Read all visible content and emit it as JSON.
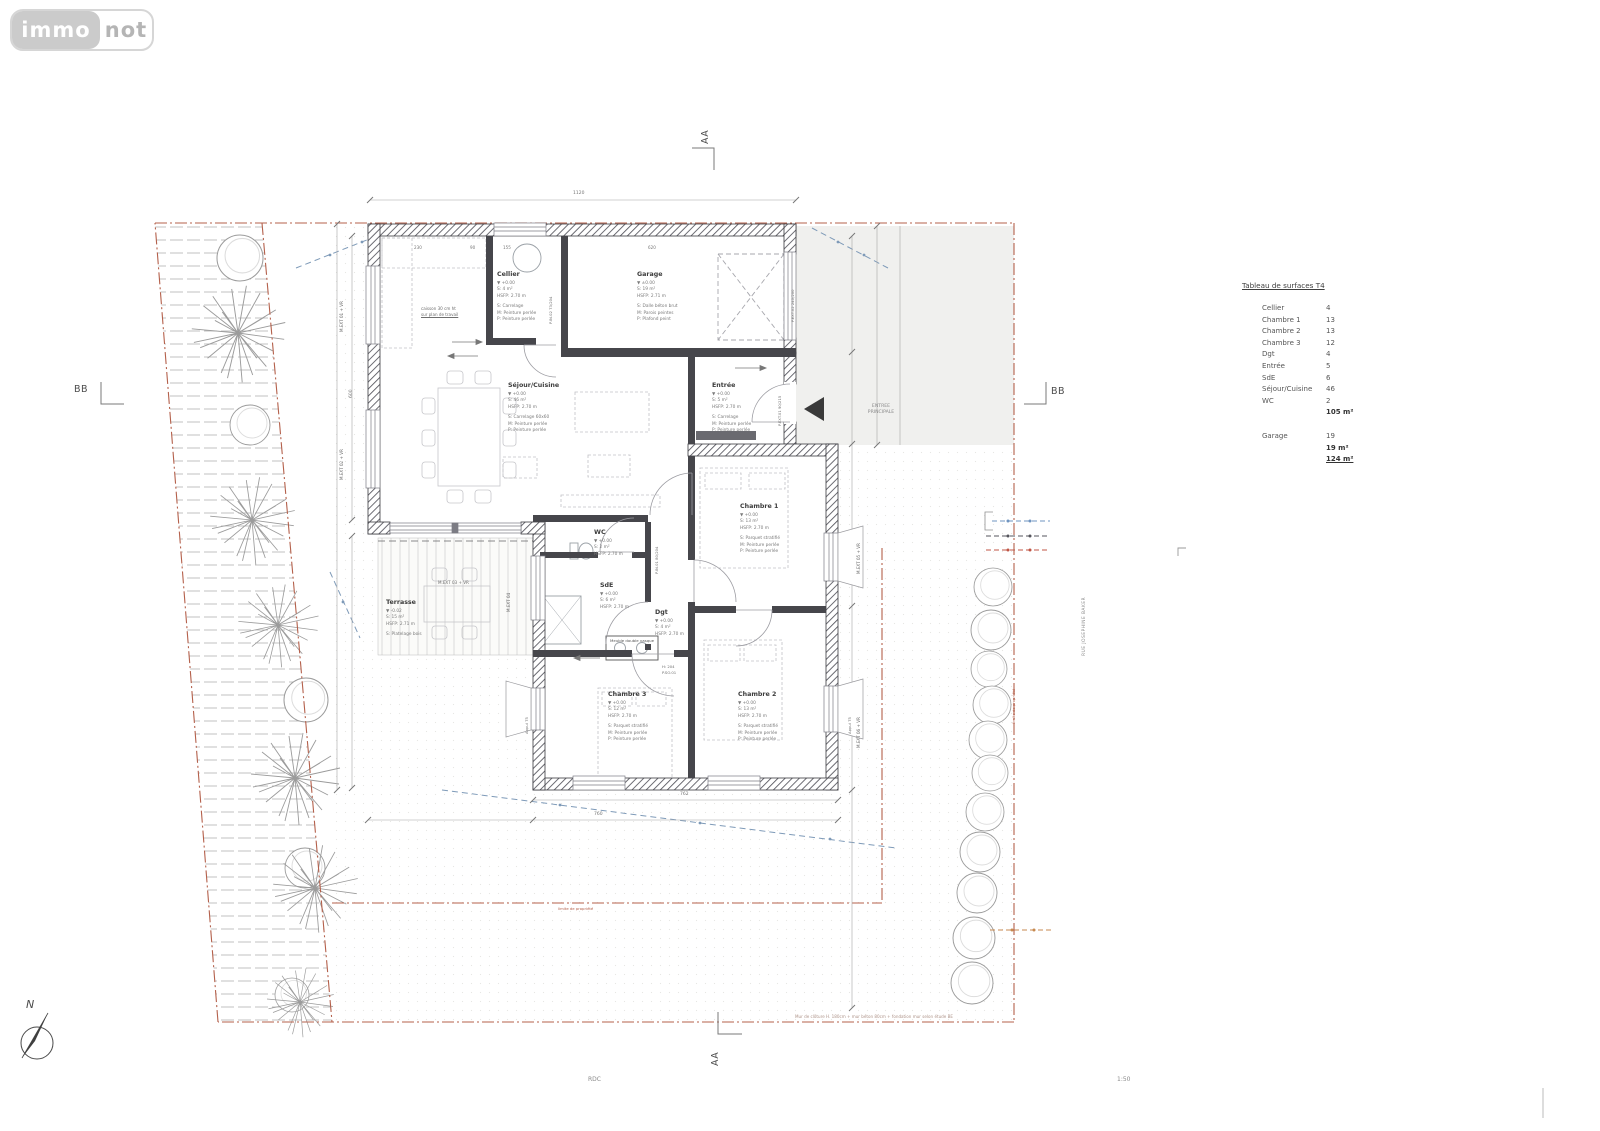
{
  "logo": {
    "immo": "immo",
    "not": "not"
  },
  "markers": {
    "aa": "AA",
    "bb": "BB",
    "north": "N"
  },
  "footer": {
    "level": "RDC",
    "scale": "1:50",
    "note": "Mur de clôture H. 180cm + mur béton 80cm + fondation mur selon étude BE"
  },
  "site": {
    "street": "RUE JOSEPHINE BAKER",
    "entrance1": "ENTREE",
    "entrance2": "PRINCIPALE",
    "boundary_note": "limite de propriété"
  },
  "surface_table": {
    "title": "Tableau de surfaces T4",
    "rows": [
      {
        "label": "Cellier",
        "value": "4"
      },
      {
        "label": "Chambre 1",
        "value": "13"
      },
      {
        "label": "Chambre 2",
        "value": "13"
      },
      {
        "label": "Chambre 3",
        "value": "12"
      },
      {
        "label": "Dgt",
        "value": "4"
      },
      {
        "label": "Entrée",
        "value": "5"
      },
      {
        "label": "SdE",
        "value": "6"
      },
      {
        "label": "Séjour/Cuisine",
        "value": "46"
      },
      {
        "label": "WC",
        "value": "2"
      }
    ],
    "subtotal": "105 m²",
    "garage": {
      "label": "Garage",
      "value": "19"
    },
    "garage_total": "19 m²",
    "grand_total": "124 m²"
  },
  "rooms": {
    "cellier": {
      "name": "Cellier",
      "level": "▼ +0.00",
      "area": "S: 4 m²",
      "height": "HSFP: 2.70 m",
      "fin1": "S: Carrelage",
      "fin2": "M: Peinture perlée",
      "fin3": "P: Peinture perlée"
    },
    "garage": {
      "name": "Garage",
      "level": "▼ ±0.00",
      "area": "S: 19 m²",
      "height": "HSFP: 2.71 m",
      "fin1": "S: Dalle béton brut",
      "fin2": "M: Parois peintes",
      "fin3": "P: Plafond peint"
    },
    "sejour": {
      "name": "Séjour/Cuisine",
      "level": "▼ +0.00",
      "area": "S: 46 m²",
      "height": "HSFP: 2.70 m",
      "fin1": "S: Carrelage 60x60",
      "fin2": "M: Peinture perlée",
      "fin3": "P: Peinture perlée"
    },
    "entree": {
      "name": "Entrée",
      "level": "▼ +0.00",
      "area": "S: 5 m²",
      "height": "HSFP: 2.70 m",
      "fin1": "S: Carrelage",
      "fin2": "M: Peinture perlée",
      "fin3": "P: Peinture perlée"
    },
    "wc": {
      "name": "WC",
      "level": "▼ +0.00",
      "area": "S: 2 m²",
      "height": "HSFP: 2.70 m"
    },
    "sde": {
      "name": "SdE",
      "level": "▼ +0.00",
      "area": "S: 6 m²",
      "height": "HSFP: 2.70 m",
      "fin1": "S: Carrelage antidérapant",
      "fin2": "M: Faïence toute hauteur",
      "fin3": "P: Peinture perlée"
    },
    "dgt": {
      "name": "Dgt",
      "level": "▼ +0.00",
      "area": "S: 4 m²",
      "height": "HSFP: 2.70 m",
      "fin1": "S: Carrelage 60x60",
      "fin2": "M: Peinture perlée",
      "fin3": "P: Peinture perlée"
    },
    "chambre1": {
      "name": "Chambre 1",
      "level": "▼ +0.00",
      "area": "S: 13 m²",
      "height": "HSFP: 2.70 m",
      "fin1": "S: Parquet stratifié",
      "fin2": "M: Peinture perlée",
      "fin3": "P: Peinture perlée"
    },
    "chambre2": {
      "name": "Chambre 2",
      "level": "▼ +0.00",
      "area": "S: 13 m²",
      "height": "HSFP: 2.70 m",
      "fin1": "S: Parquet stratifié",
      "fin2": "M: Peinture perlée",
      "fin3": "P: Peinture perlée"
    },
    "chambre3": {
      "name": "Chambre 3",
      "level": "▼ +0.00",
      "area": "S: 12 m²",
      "height": "HSFP: 2.70 m",
      "fin1": "S: Parquet stratifié",
      "fin2": "M: Peinture perlée",
      "fin3": "P: Peinture perlée"
    },
    "terrasse": {
      "name": "Terrasse",
      "level": "▼ -0.02",
      "area": "S: 15 m²",
      "height": "HSFP: 2.71 m",
      "fin1": "S: Platelage bois"
    }
  },
  "wall_labels": {
    "w1": "M.EXT 01 + VR",
    "w2": "M.EXT 02 + VR",
    "w3": "M.EXT 03 + VR",
    "w4": "M.EXT 04",
    "w5": "M.EXT 05 + VR",
    "w6": "M.EXT 06 + VR",
    "appui": "Appui 75"
  },
  "door_labels": {
    "d1": "P.IN.02 73/204",
    "d2": "F.EXT.02 240/200",
    "d3": "P.EXT.01 90/215",
    "d4": "P.IN.01 80/204",
    "d5": "H: 204",
    "d6": "P.SO.01"
  },
  "notes": {
    "kitchen1": "caisson 30 cm ht",
    "kitchen2": "sur plan de travail",
    "vanity": "Meuble double vasque"
  },
  "dims": {
    "top": "1120",
    "a": "230",
    "b": "90",
    "c": "155",
    "d": "620",
    "bottom1": "762",
    "bottom2": "760",
    "left": "600"
  }
}
